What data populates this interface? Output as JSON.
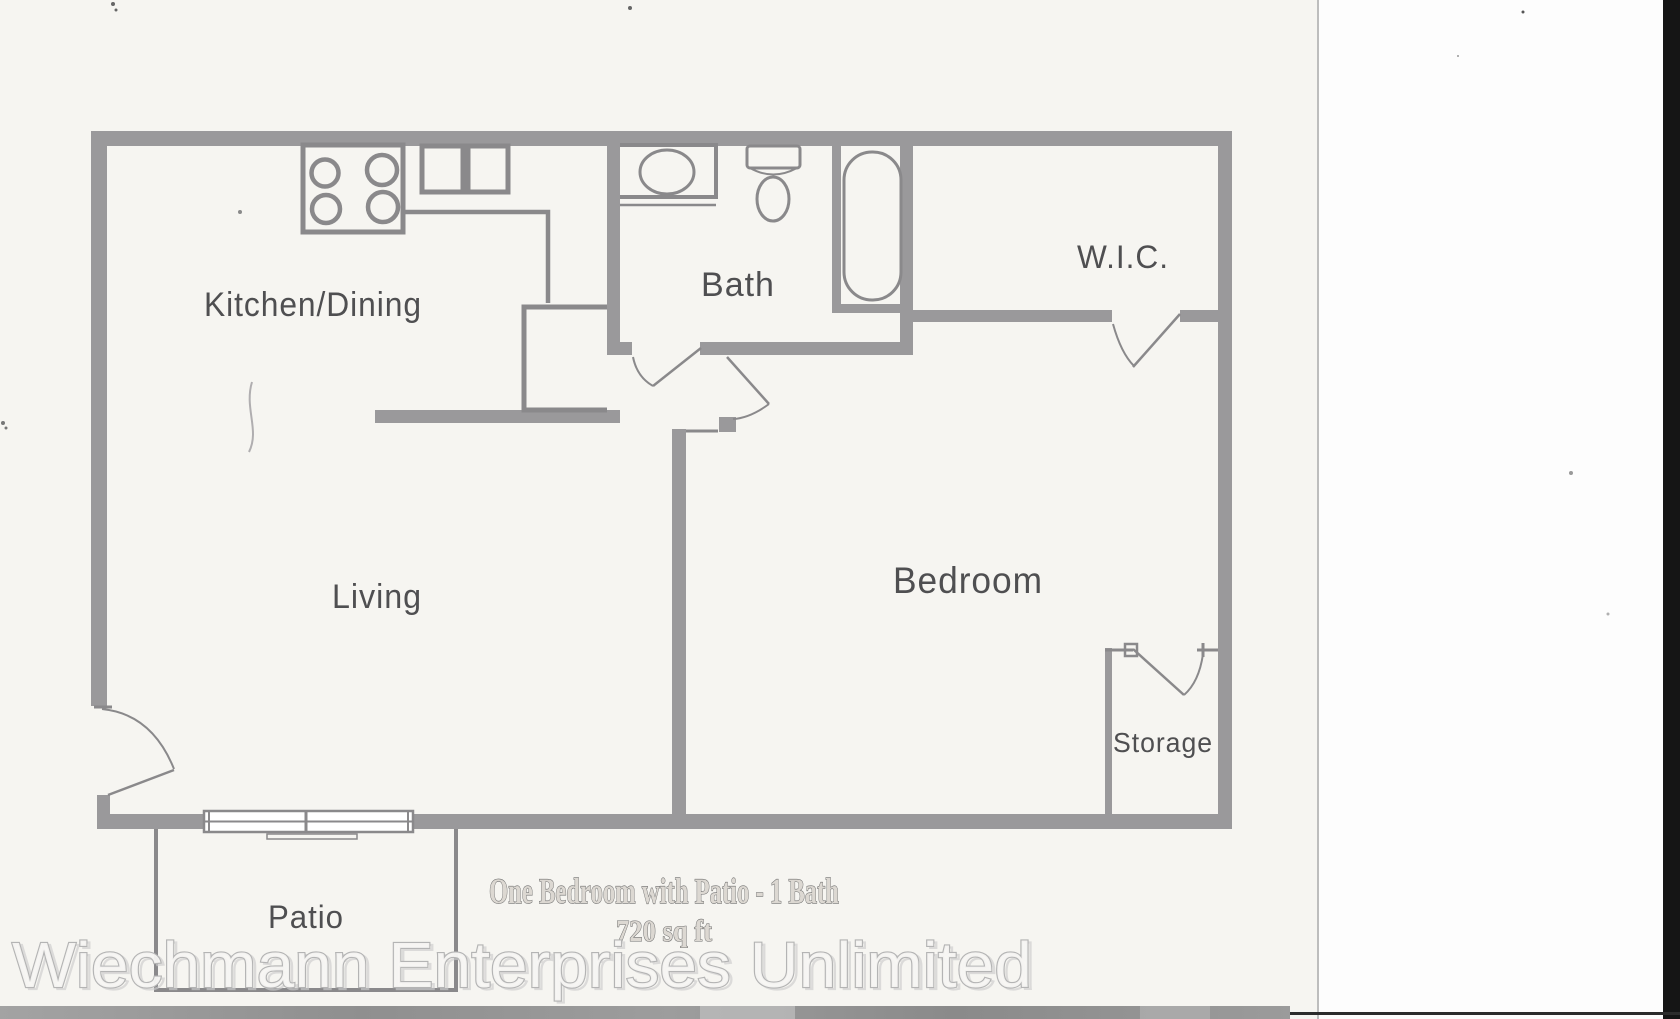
{
  "document": {
    "rooms": {
      "kitchen_dining": "Kitchen/Dining",
      "bath": "Bath",
      "wic": "W.I.C.",
      "living": "Living",
      "bedroom": "Bedroom",
      "storage": "Storage",
      "patio": "Patio"
    },
    "caption": {
      "title": "One Bedroom with Patio - 1 Bath",
      "area": "720 sq ft"
    },
    "watermark": "Wiechmann Enterprises Unlimited",
    "fixtures": [
      "stove-icon",
      "kitchen-sink-icon",
      "pantry-icon",
      "counter-icon",
      "bathroom-sink-icon",
      "toilet-icon",
      "bathtub-icon",
      "sliding-patio-door-icon",
      "entry-door-icon",
      "bath-door-icon",
      "bedroom-door-icon",
      "wic-door-icon",
      "storage-door-icon"
    ],
    "colors": {
      "wall": "#9a999b",
      "fixture_line": "#8a898b",
      "room_label": "#4f4f51",
      "caption_text": "#6f6f6f",
      "watermark_fill": "#f7f6f4",
      "watermark_outline": "#b4b4b4",
      "paper": "#f6f5f1",
      "scanner_band": "#969696",
      "edge_black": "#151515"
    }
  }
}
